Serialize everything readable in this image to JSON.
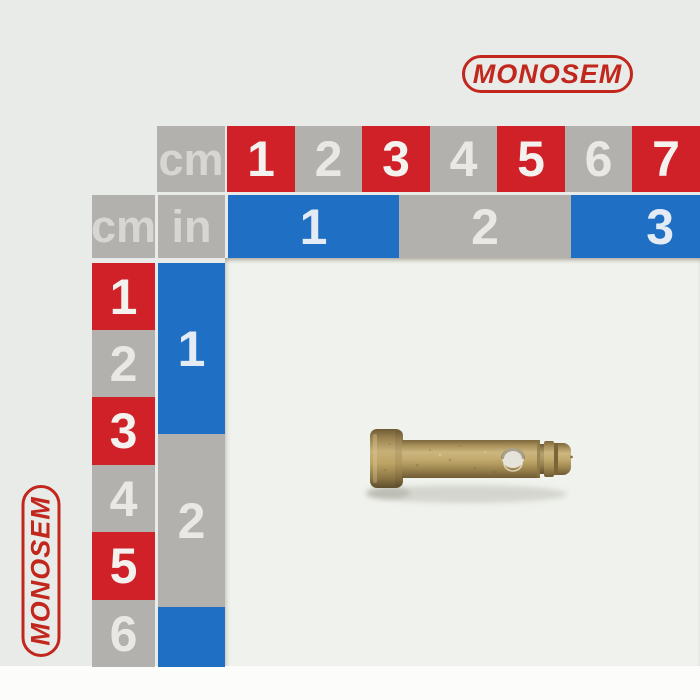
{
  "brand": {
    "logo_text": "MONOSEM",
    "logo_color": "#c1271d"
  },
  "rulers": {
    "unit_labels": {
      "top_cm": "cm",
      "left_cm": "cm",
      "in": "in"
    },
    "top_cm_cells": [
      {
        "n": "1",
        "color": "red"
      },
      {
        "n": "2",
        "color": "gray"
      },
      {
        "n": "3",
        "color": "red"
      },
      {
        "n": "4",
        "color": "gray"
      },
      {
        "n": "5",
        "color": "red"
      },
      {
        "n": "6",
        "color": "gray"
      },
      {
        "n": "7",
        "color": "red"
      }
    ],
    "top_in_cells": [
      {
        "n": "1",
        "color": "blue"
      },
      {
        "n": "2",
        "color": "gray"
      },
      {
        "n": "3",
        "color": "blue"
      }
    ],
    "left_cm_cells": [
      {
        "n": "1",
        "color": "red"
      },
      {
        "n": "2",
        "color": "gray"
      },
      {
        "n": "3",
        "color": "red"
      },
      {
        "n": "4",
        "color": "gray"
      },
      {
        "n": "5",
        "color": "red"
      },
      {
        "n": "6",
        "color": "gray"
      }
    ],
    "left_in_cells": [
      {
        "n": "1",
        "color": "blue"
      },
      {
        "n": "2",
        "color": "gray"
      },
      {
        "n": "",
        "color": "blue"
      }
    ]
  },
  "colors": {
    "red": "#d02028",
    "blue": "#1f70c4",
    "gray": "#b3b1ad",
    "backdrop": "#e8ebe7",
    "interior_white": "#f0f2ed",
    "brass": "#b59a62",
    "logo_red": "#c1271d"
  },
  "photo_object": {
    "name": "brass clevis pin",
    "description": "brass clevis pin with cylindrical head, cross hole and grooved tip, lying on a cm/inch measuring board"
  }
}
